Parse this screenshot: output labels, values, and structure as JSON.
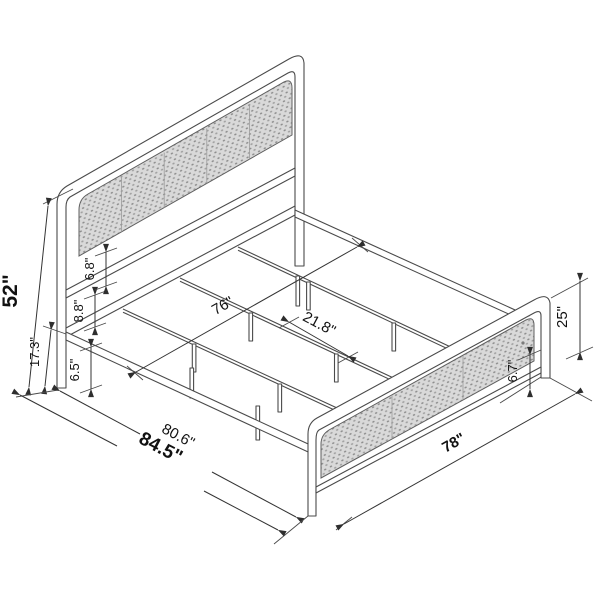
{
  "diagram": {
    "title": "bed-frame-dimension-diagram",
    "subject": "cane panel metal platform bed isometric drawing",
    "colors": {
      "line": "#4a4a4a",
      "panel_fill": "#dadada",
      "label": "#111111"
    },
    "dimensions": {
      "headboard_height": "52\"",
      "platform_height": "17.3\"",
      "underbed_clearance": "6.5\"",
      "rail_gap": "8.8\"",
      "panel_gap": "6.8\"",
      "inner_width": "76\"",
      "slat_spacing": "21.8\"",
      "inner_length": "80.6\"",
      "overall_length": "84.5\"",
      "overall_width": "78\"",
      "footboard_height": "25\"",
      "footboard_clearance": "6.7\""
    }
  }
}
